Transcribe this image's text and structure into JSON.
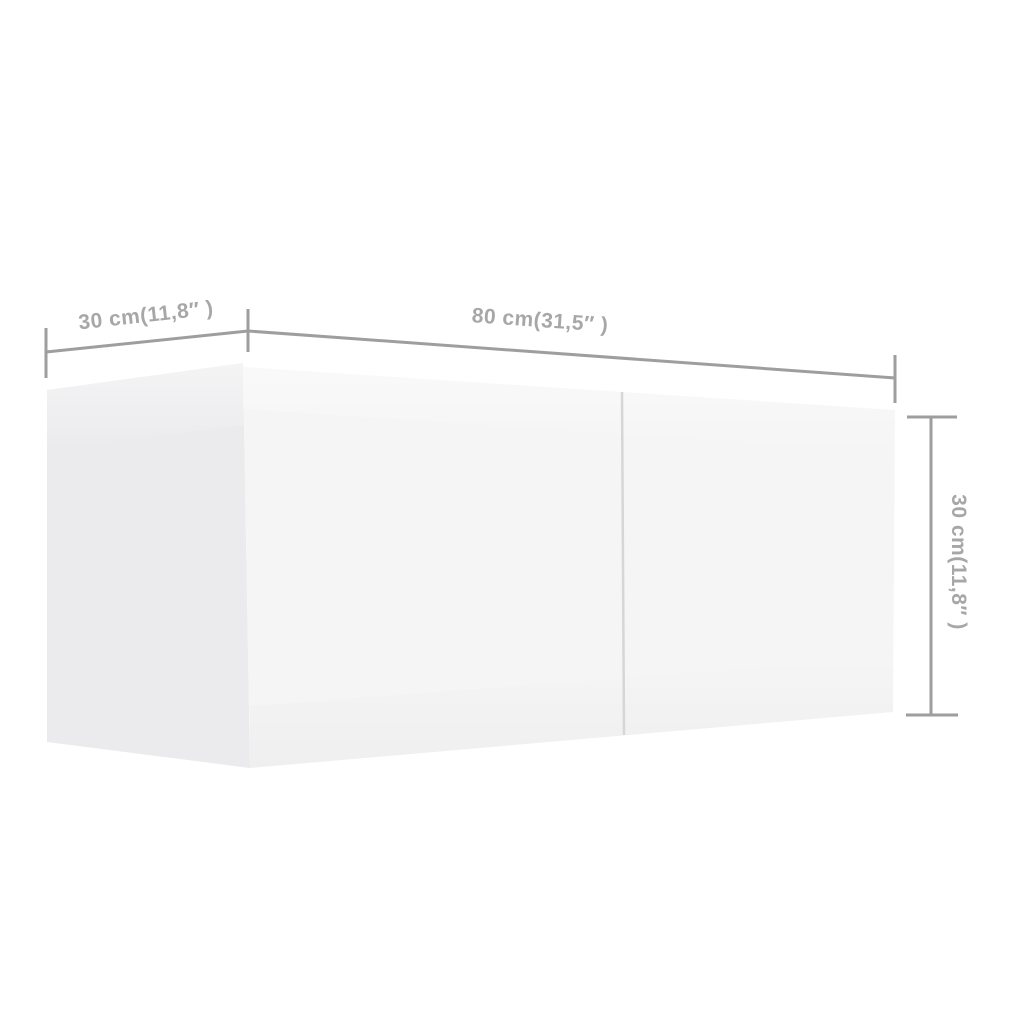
{
  "diagram": {
    "type": "product-dimension-diagram",
    "subject": "wall-mounted cabinet, two front sections, shown in left-front perspective",
    "dimensions": {
      "depth": {
        "label": "30 cm(11,8″ )",
        "cm": "30",
        "inches": "11,8",
        "placement": "top-left, along top edge of side panel"
      },
      "width": {
        "label": "80 cm(31,5″ )",
        "cm": "80",
        "inches": "31,5",
        "placement": "top, along top edge of front panel"
      },
      "height": {
        "label": "30 cm(11,8″ )",
        "cm": "30",
        "inches": "11,8",
        "placement": "right side, rotated 90°"
      }
    }
  },
  "colors": {
    "background": "#ffffff",
    "dimension_line": "#9e9e9e",
    "dimension_text": "#a7a7a7",
    "cabinet_front": "#f5f5f6",
    "cabinet_side": "#ebebed",
    "door_gap": "#d6d6d9"
  }
}
